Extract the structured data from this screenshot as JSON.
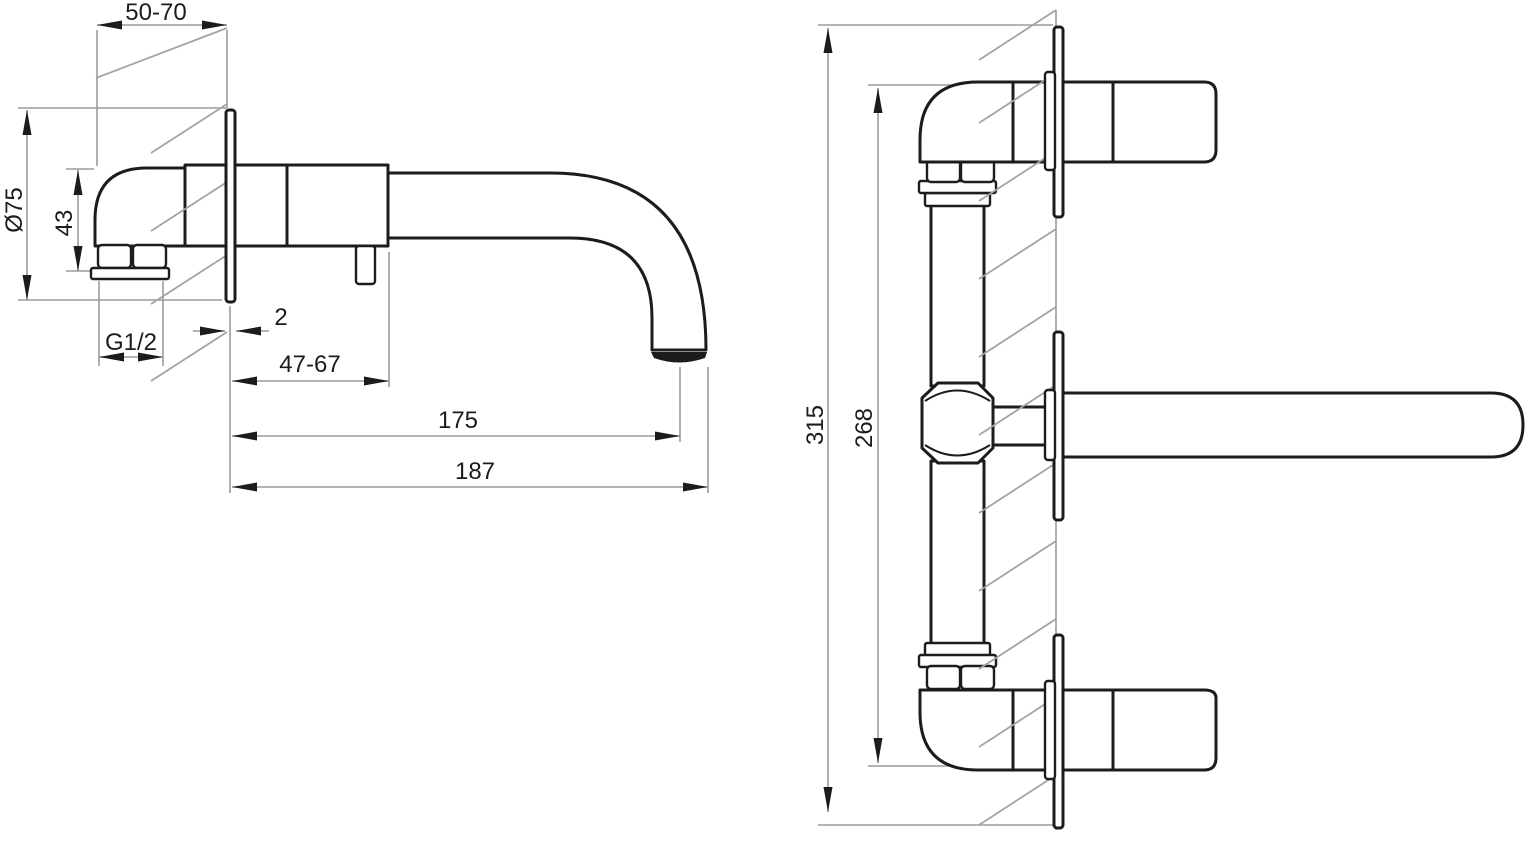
{
  "drawing": {
    "type": "technical-dimension-drawing",
    "subject": "Wall-mounted basin mixer faucet, side view and front view with installation dimensions",
    "units": "mm",
    "colors": {
      "outline": "#1c1c1c",
      "dimension_lines": "#9b9b9b",
      "hatching": "#a3a3a3",
      "text": "#1c1c1c",
      "background": "#ffffff"
    },
    "side_view": {
      "name": "side view",
      "dimensions": [
        {
          "id": "wall-depth-range",
          "label": "50-70"
        },
        {
          "id": "escutcheon-diameter",
          "label": "Ø75"
        },
        {
          "id": "body-height",
          "label": "43"
        },
        {
          "id": "thread-size",
          "label": "G1/2"
        },
        {
          "id": "escutcheon-thickness",
          "label": "2"
        },
        {
          "id": "body-projection-range",
          "label": "47-67"
        },
        {
          "id": "spout-reach-to-outlet",
          "label": "175"
        },
        {
          "id": "spout-reach-overall",
          "label": "187"
        }
      ]
    },
    "front_view": {
      "name": "front view",
      "dimensions": [
        {
          "id": "overall-height",
          "label": "315"
        },
        {
          "id": "connection-centres-height",
          "label": "268"
        }
      ]
    }
  }
}
